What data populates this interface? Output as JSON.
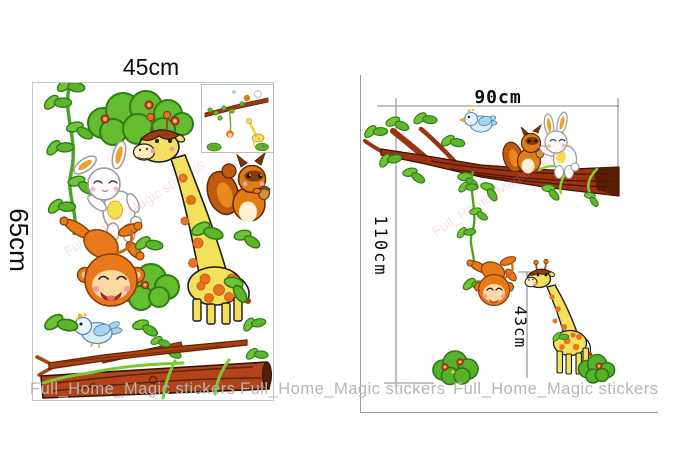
{
  "left_panel": {
    "width_label": "45cm",
    "height_label": "65cm",
    "stickers": [
      "climbing-vine",
      "flower-bush",
      "rabbit",
      "giraffe",
      "squirrel",
      "monkey",
      "bush",
      "bluebird",
      "leaf-clusters",
      "thin-branch",
      "log-branch",
      "preview-inset"
    ]
  },
  "right_panel": {
    "width_label": "90cm",
    "height_label": "110cm",
    "giraffe_height_label": "43cm",
    "elements": [
      "tree-branch",
      "bluebird",
      "squirrel",
      "rabbit",
      "hanging-vine",
      "monkey",
      "giraffe",
      "flower-bush-left",
      "flower-bush-right"
    ]
  },
  "watermark_text": "Full_Home_Magic stickers",
  "watermarks": [
    "Full_Home_Magic stickers",
    "Full_Home_Magic stickers",
    "Full_Home_Magic stickers"
  ],
  "colors": {
    "leaf_green": "#64bd2e",
    "leaf_outline": "#2f7d15",
    "branch_brown": "#9c3210",
    "log_brown": "#b2441a",
    "monkey_orange": "#e8791a",
    "giraffe_yellow": "#f4e05a",
    "spot_orange": "#e8731e",
    "squirrel_brown": "#e07c16",
    "bird_blue": "#d8edfb",
    "scarf_yellow": "#f3e24e",
    "mane_red": "#a33a0e",
    "dimension_gray": "#8a8a8a",
    "watermark_gray": "#b6b6b6"
  }
}
